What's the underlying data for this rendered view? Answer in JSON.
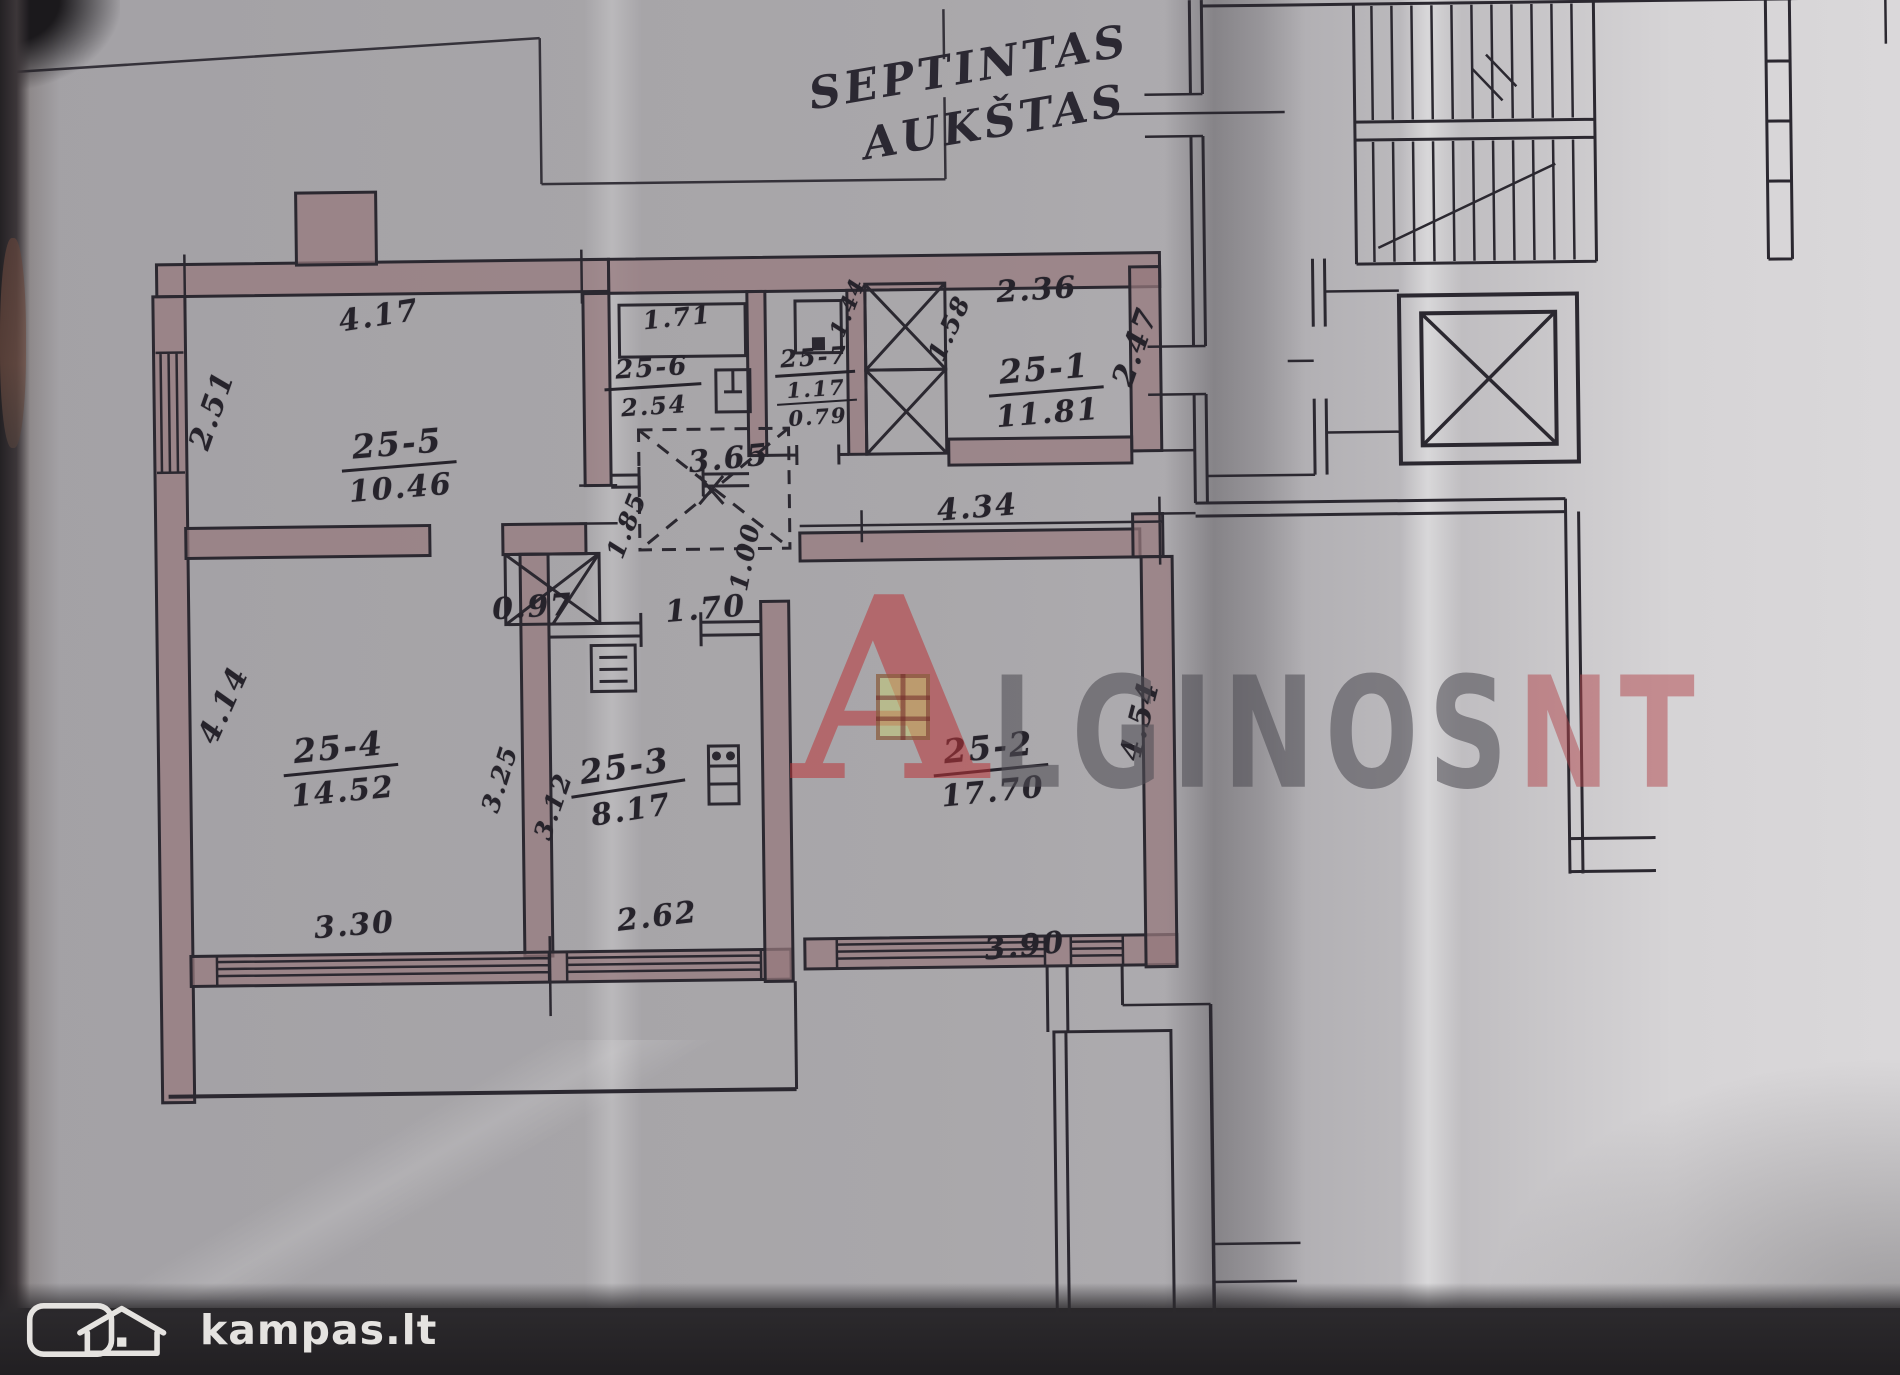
{
  "title": {
    "line1": "SEPTINTAS",
    "line2": "AUKŠTAS"
  },
  "rooms": [
    {
      "id": "25-5",
      "area": "10.46"
    },
    {
      "id": "25-6",
      "area": "2.54"
    },
    {
      "id": "25-7",
      "area": "1.17",
      "area2": "0.79"
    },
    {
      "id": "25-1",
      "area": "11.81"
    },
    {
      "id": "25-4",
      "area": "14.52"
    },
    {
      "id": "25-3",
      "area": "8.17"
    },
    {
      "id": "25-2",
      "area": "17.70"
    }
  ],
  "dims": {
    "d417": "4.17",
    "d251": "2.51",
    "d171": "1.71",
    "d236": "2.36",
    "d158": "1.58",
    "d247": "2.47",
    "d144": "1.44",
    "d365": "3.65",
    "d185": "1.85",
    "d100": "1.00",
    "d170": "1.70",
    "d097": "0.97",
    "d434": "4.34",
    "d414": "4.14",
    "d325": "3.25",
    "d312": "3.12",
    "d454": "4.54",
    "d330": "3.30",
    "d262": "2.62",
    "d390": "3.90"
  },
  "watermark": {
    "letter": "A",
    "text": "LGINOS",
    "suffix": "NT",
    "accent_color": "#ba3438",
    "text_color": "#565459"
  },
  "footer": {
    "brand": "kampas.lt"
  }
}
